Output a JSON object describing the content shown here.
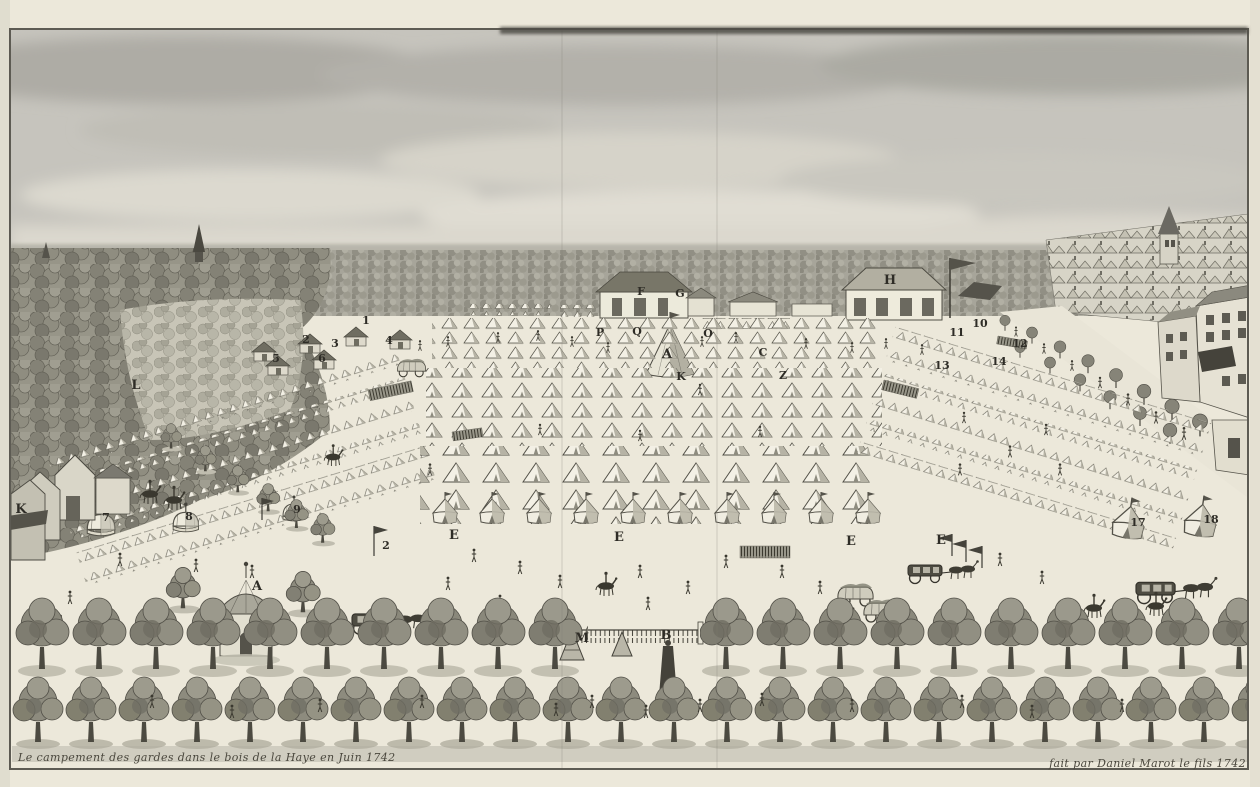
{
  "artwork": {
    "inscription_left": "Le campement des gardes dans le bois de la Haye en Juin 1742",
    "inscription_right": "fait par Daniel Marot le fils 1742"
  },
  "markers": [
    "1",
    "2",
    "3",
    "4",
    "5",
    "6",
    "7",
    "8",
    "9",
    "10",
    "11",
    "12",
    "13",
    "14",
    "17",
    "18",
    "A",
    "A",
    "B",
    "C",
    "E",
    "E",
    "E",
    "E",
    "F",
    "G",
    "H",
    "K",
    "K",
    "L",
    "M",
    "O",
    "P",
    "Q",
    "Z",
    "2"
  ],
  "palette": {
    "paper": "#ece8da",
    "sky_wash": "#c6c4bd",
    "cloud_light": "#dfdcd2",
    "cloud_shadow": "#aeaca5",
    "ink": "#3f3d36",
    "foliage": "#8a887c",
    "tent_white": "#f3f0e5",
    "wash_shadow": "#b9b6a9"
  }
}
